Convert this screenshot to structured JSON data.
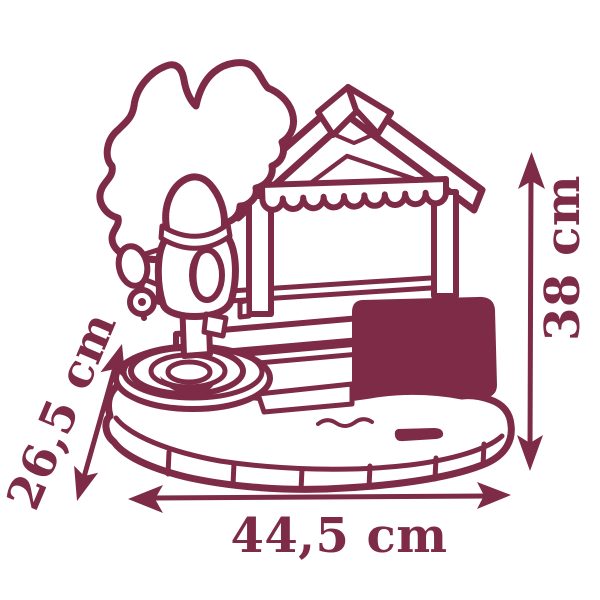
{
  "figure": {
    "type": "product-dimension-diagram",
    "subject": "playhouse with water pump and basin, line drawing",
    "ink_color": "#7d2b47",
    "background_color": "#ffffff",
    "dimensions": {
      "height": {
        "label": "38 cm",
        "value": "38",
        "unit": "cm",
        "orientation": "vertical-right"
      },
      "width": {
        "label": "44,5 cm",
        "value": "44,5",
        "unit": "cm",
        "orientation": "horizontal-bottom"
      },
      "depth": {
        "label": "26,5 cm",
        "value": "26,5",
        "unit": "cm",
        "orientation": "diagonal-left"
      }
    }
  }
}
